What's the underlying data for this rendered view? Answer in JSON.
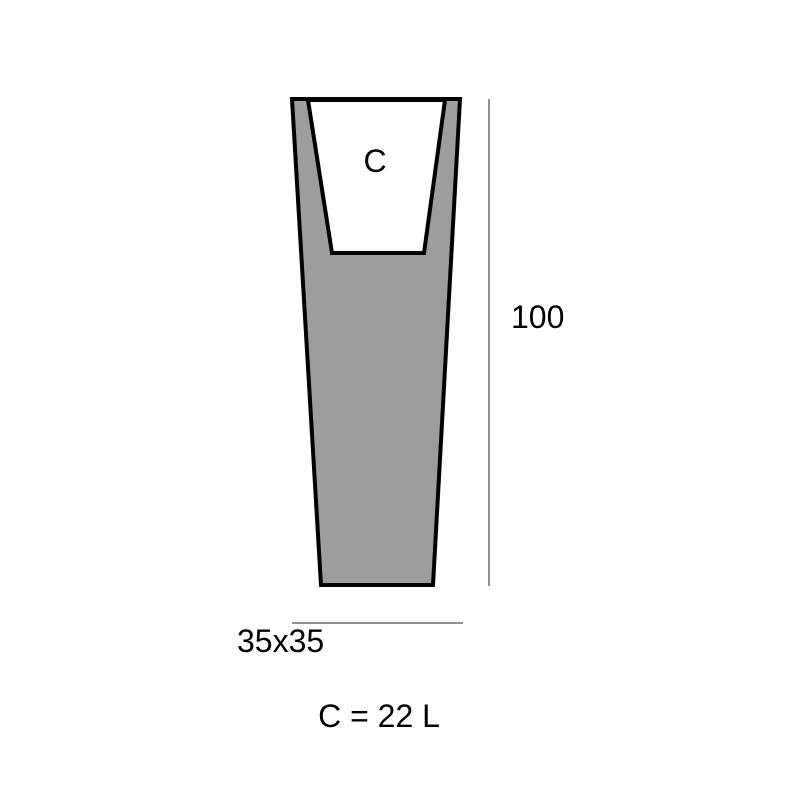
{
  "diagram": {
    "cavity_label": "C",
    "height_value": "100",
    "base_dimensions": "35x35",
    "capacity_text": "C = 22 L"
  },
  "colors": {
    "body_fill": "#9d9d9b",
    "cavity_fill": "#ffffff",
    "outline": "#000000",
    "dimension_line": "#909090",
    "text": "#000000",
    "background": "#ffffff"
  }
}
